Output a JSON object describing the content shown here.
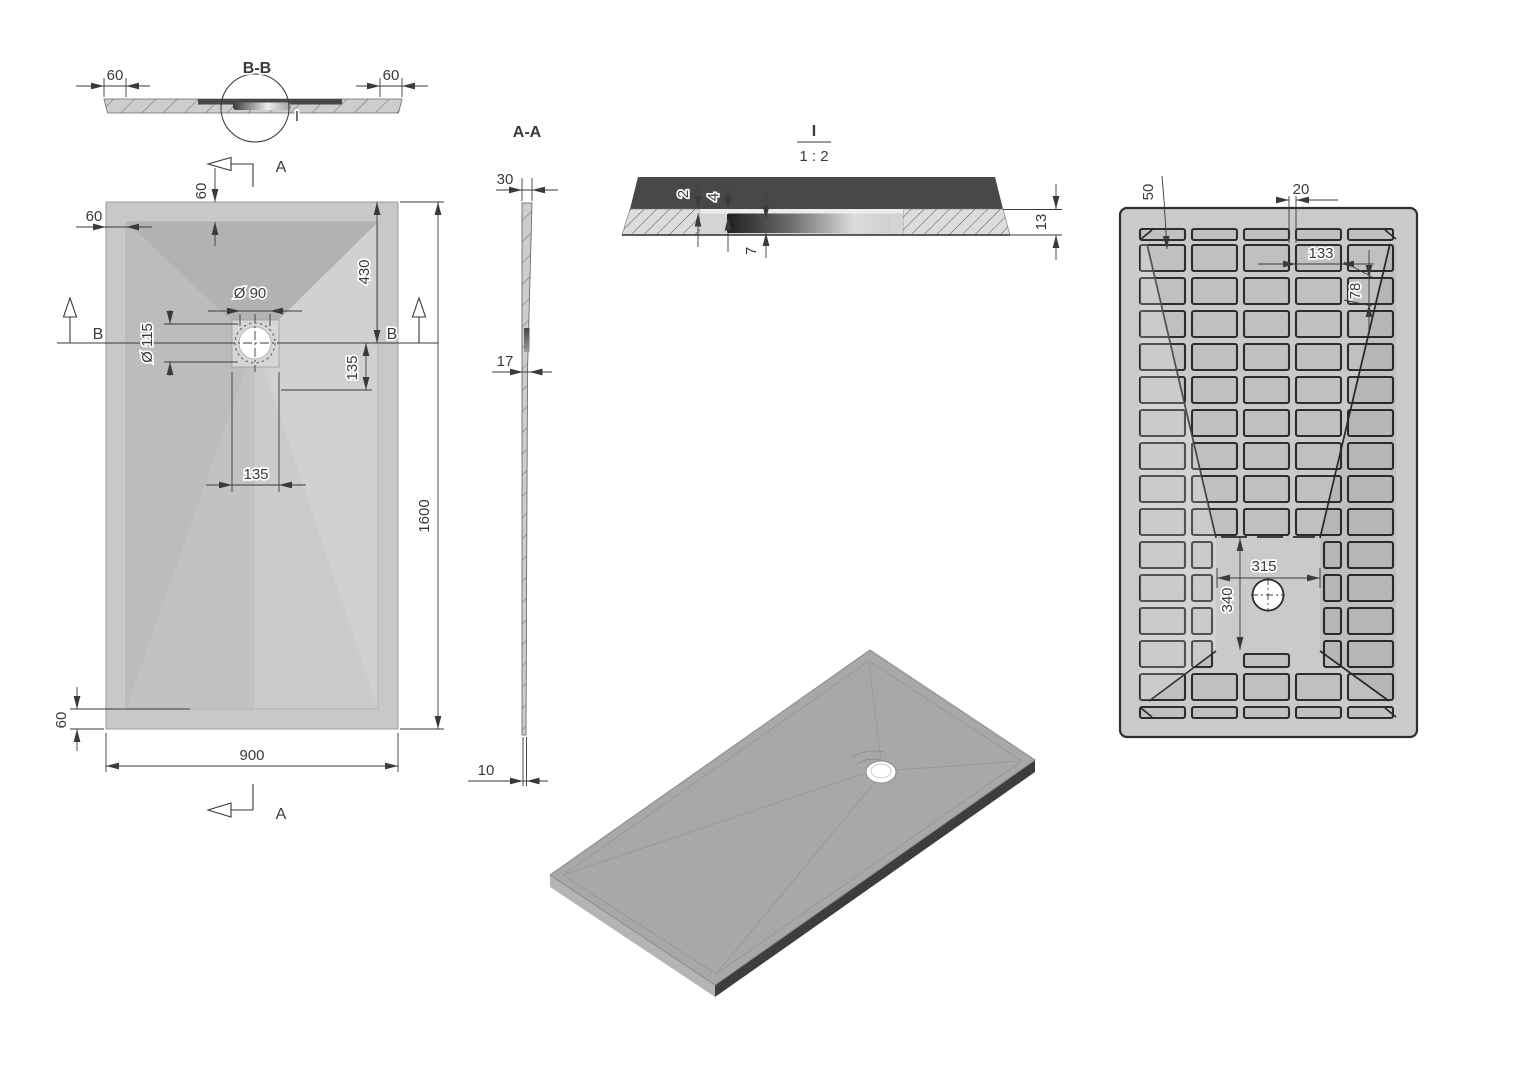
{
  "labels": {
    "section_bb": {
      "title": "B-B",
      "detail_ref": "I",
      "dim_left": "60",
      "dim_right": "60"
    },
    "plan": {
      "cut_top": "A",
      "cut_bottom": "A",
      "marker_left": "B",
      "marker_right": "B",
      "dim_rim_top": "60",
      "dim_rim_left": "60",
      "dim_rim_bottom": "60",
      "dim_drain_from_top": "430",
      "dim_diam_inner": "Ø 90",
      "dim_diam_outer": "Ø 115",
      "dim_offset_right": "135",
      "dim_offset_bottom": "135",
      "dim_length": "1600",
      "dim_width": "900"
    },
    "section_aa": {
      "title": "A-A",
      "dim_top": "30",
      "dim_middle": "17",
      "dim_bottom": "10"
    },
    "detail_i": {
      "title": "I",
      "scale": "1 : 2",
      "dim_gap": "2",
      "dim_lip": "4",
      "dim_recess": "7",
      "dim_thickness": "13"
    },
    "bottom_view": {
      "dim_rib_offset": "50",
      "dim_rib_width": "20",
      "dim_pocket_width": "133",
      "dim_pocket_height": "78",
      "dim_open_width": "315",
      "dim_open_height": "340"
    }
  },
  "colors": {
    "background": "#ffffff",
    "line": "#3a3a3a",
    "outline": "#2f2f2f",
    "plate": "#cacaca",
    "pocket": "#c0c0c0",
    "rim": "#c8c8c8",
    "facet_top": "#b2b2b2",
    "facet_left": "#bcbcbc",
    "facet_right": "#d1d1d1",
    "facet_bottom_left": "#c2c2c2",
    "facet_bottom_right": "#cbcbcb",
    "strip": "#cdcdcd",
    "section_band": "#484848",
    "iso_top": "#a8a8a8",
    "iso_side_dark": "#3d3d3d",
    "iso_side_light": "#b5b5b5"
  }
}
